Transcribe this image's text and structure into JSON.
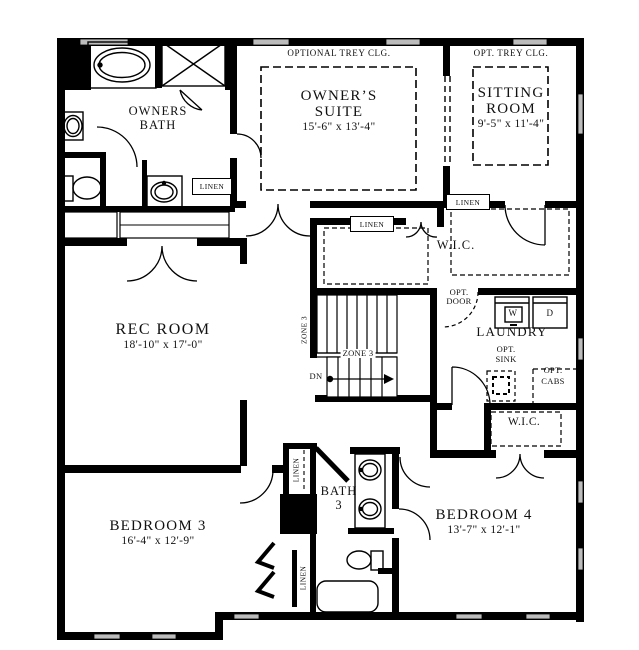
{
  "rooms": {
    "owners_bath": {
      "name_line1": "OWNERS",
      "name_line2": "BATH"
    },
    "owners_suite": {
      "ceiling": "OPTIONAL TREY CLG.",
      "name_line1": "OWNER’S",
      "name_line2": "SUITE",
      "dims": "15'-6\" x 13'-4\""
    },
    "sitting_room": {
      "ceiling": "OPT. TREY CLG.",
      "name_line1": "SITTING",
      "name_line2": "ROOM",
      "dims": "9'-5\" x 11'-4\""
    },
    "wic_main": {
      "name": "W.I.C."
    },
    "rec_room": {
      "name": "REC ROOM",
      "dims": "18'-10\" x 17'-0\""
    },
    "laundry": {
      "name": "LAUNDRY"
    },
    "wic_bed4": {
      "name": "W.I.C."
    },
    "bath3": {
      "name_line1": "BATH",
      "name_line2": "3"
    },
    "bedroom3": {
      "name": "BEDROOM 3",
      "dims": "16'-4\" x 12'-9\""
    },
    "bedroom4": {
      "name": "BEDROOM 4",
      "dims": "13'-7\" x 12'-1\""
    }
  },
  "closets": {
    "linen_bath": "LINEN",
    "linen_wic_left": "LINEN",
    "linen_wic_right": "LINEN",
    "linen_hall_upper": "LINEN",
    "linen_hall_lower": "LINEN"
  },
  "stairs": {
    "zone_upper": "ZONE 3",
    "zone_lower": "ZONE 3",
    "direction": "DN"
  },
  "options": {
    "door_line1": "OPT.",
    "door_line2": "DOOR",
    "sink_line1": "OPT.",
    "sink_line2": "SINK",
    "cabs_line1": "OPT.",
    "cabs_line2": "CABS"
  },
  "appliances": {
    "washer": "W",
    "dryer": "D"
  },
  "colors": {
    "wall": "#000000",
    "window": "#bcbcbc",
    "background": "#ffffff"
  }
}
